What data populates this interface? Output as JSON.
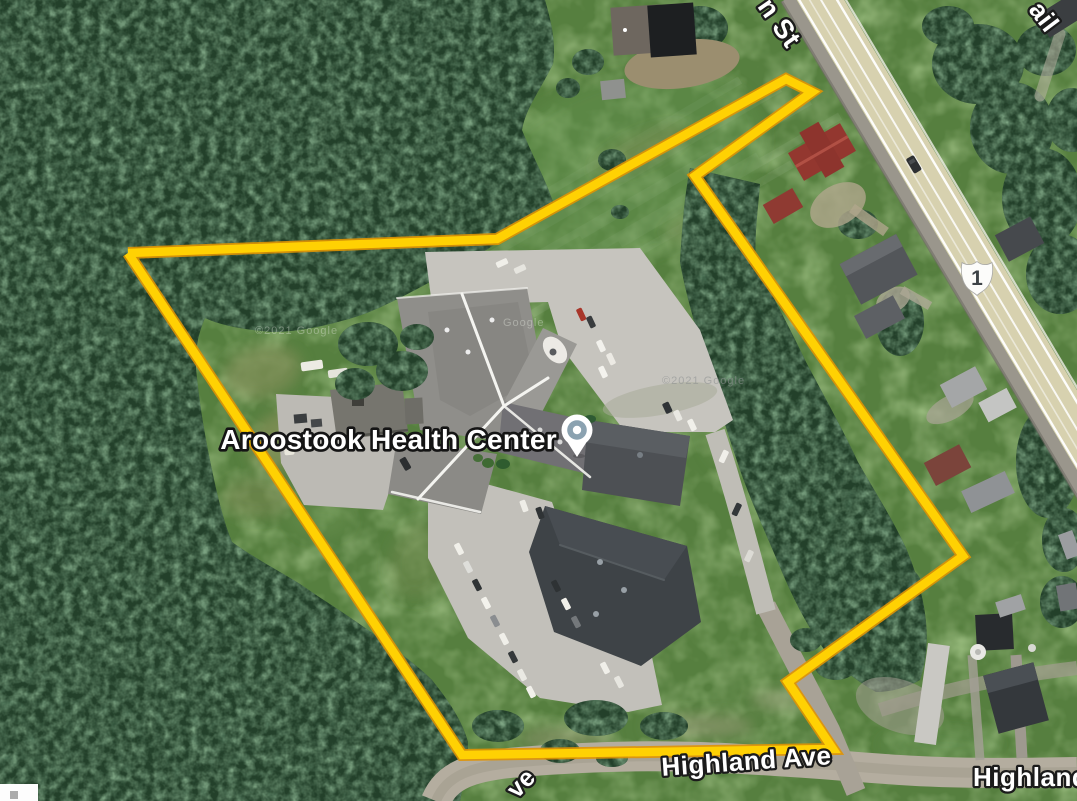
{
  "map": {
    "place": {
      "label": "Aroostook Health Center"
    },
    "road_labels": {
      "main_st_partial": "n St",
      "trail_partial": "ail",
      "highland_ave": "Highland Ave",
      "highland_partial": "Highland A",
      "ave_partial": "ve"
    },
    "route_shield": {
      "system": "US Route",
      "number": "1"
    },
    "watermarks": [
      {
        "text": "©2021 Google"
      },
      {
        "text": "Google"
      },
      {
        "text": "©2021 Google"
      }
    ],
    "parcel": {
      "points_attr": "128,253 497,239 786,79 812,92 695,176 963,556 788,682 833,749 462,755 128,253",
      "color": "#FFD103"
    },
    "colors": {
      "parcel_yellow": "#FFD103",
      "forest_green": "#23402a",
      "field_green": "#567f3f",
      "road_tan": "#D7D1AF",
      "road_gray": "#B4AD9F",
      "marker_ring": "#8BA2B0"
    }
  }
}
